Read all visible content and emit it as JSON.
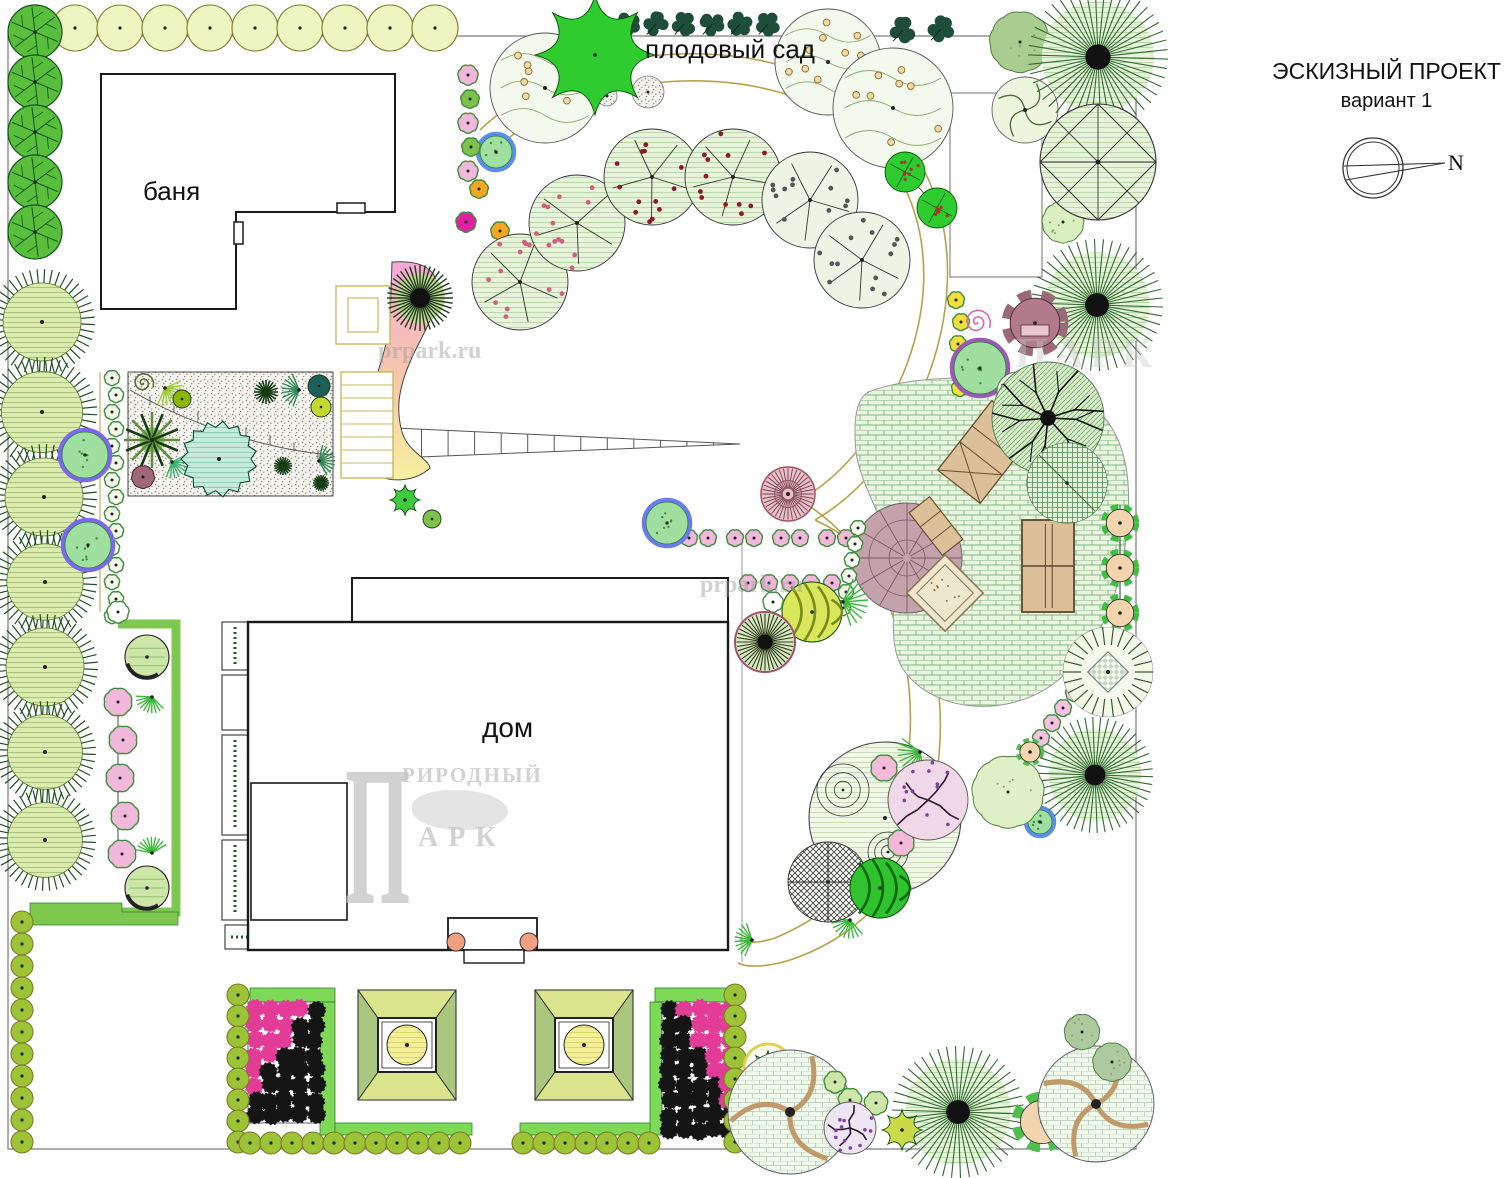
{
  "title": {
    "line1": "ЭСКИЗНЫЙ ПРОЕКТ",
    "line2": "вариант 1"
  },
  "compass": {
    "label": "N"
  },
  "labels": {
    "orchard": "плодовый сад",
    "bathhouse": "баня",
    "house": "дом"
  },
  "watermarks": {
    "site1": "prpark.ru",
    "site2": "prpark.ru",
    "logo_initial": "П",
    "logo_word1": "РИРОДНЫЙ",
    "logo_word2": "АРК",
    "logo_partial": "ПАРК"
  },
  "colors": {
    "boundary": "#777777",
    "path_tan": "#B5A24A",
    "building_line": "#1a1a1a",
    "green_band": "#7EC850",
    "hedge_olive": "#9CC436",
    "hedge_pale": "#EDF5C0",
    "pink_flower": "#F2B8DC",
    "black_flower": "#151515",
    "magenta_flower": "#E23C96",
    "furniture_tan": "#DCC09A",
    "plaza_mauve": "#C4A2AC",
    "gradient_pink": "#F9A8D8",
    "gradient_yellow": "#F7F0A0"
  },
  "plan": {
    "boundary": {
      "x": 8,
      "y": 36,
      "w": 1128,
      "h": 1113
    },
    "buildings": {
      "bathhouse_outline": [
        [
          101,
          74
        ],
        [
          395,
          74
        ],
        [
          395,
          212
        ],
        [
          236,
          212
        ],
        [
          236,
          309
        ],
        [
          101,
          309
        ]
      ],
      "bathhouse_door1": [
        337,
        203,
        28,
        10
      ],
      "bathhouse_door2": [
        234,
        222,
        9,
        22
      ],
      "house_porch": [
        352,
        578,
        376,
        44
      ],
      "house_main": [
        248,
        622,
        480,
        328
      ],
      "house_inner": [
        251,
        783,
        96,
        137
      ],
      "house_entry": [
        448,
        918,
        89,
        32
      ],
      "entry_step": [
        464,
        950,
        60,
        13
      ],
      "entry_posts": [
        [
          456,
          942,
          9
        ],
        [
          529,
          942,
          9
        ]
      ],
      "aux_plot": [
        950,
        93,
        92,
        184
      ]
    },
    "paths_tan": [
      "M480,130C585,30 800,25 900,135C965,210 960,330 905,425C880,468 850,500 815,520",
      "M492,152C590,60 790,55 880,150C940,220 935,325 885,410C862,450 835,480 800,500",
      "M815,520C900,560 945,640 940,740C935,850 880,930 790,960C765,968 745,967 738,963",
      "M800,500C875,545 915,635 910,735C905,835 855,905 775,938C757,944 744,943 740,939"
    ],
    "pergola": {
      "x1": 395,
      "yt": 428,
      "yb": 458,
      "x2": 740,
      "y2": 444,
      "ticks": 12
    },
    "gradient_bed": "M392,262 C420,260 438,268 437,290 C436,318 420,338 410,362 C398,390 396,410 402,432 C408,452 428,458 430,468 C415,482 388,484 372,472 C360,462 360,440 364,420 C370,390 388,350 390,320 Z",
    "rock_garden": [
      128,
      372,
      205,
      124
    ],
    "rock_curve": "M130,390 C210,436 290,452 333,455",
    "steps": {
      "deck": [
        336,
        286,
        54,
        58
      ],
      "deck_inner": [
        348,
        298,
        30,
        34
      ],
      "ladder": [
        341,
        372,
        52,
        106
      ]
    },
    "plaza": "M868,392 C920,372 1010,375 1065,392 C1115,408 1132,455 1128,515 C1124,585 1105,645 1052,685 C1005,718 935,712 905,672 C885,645 898,605 892,562 C886,520 860,485 856,452 C853,420 856,400 868,392 Z",
    "plaza_circle": [
      907,
      558,
      55
    ],
    "furniture": {
      "lounge": [
        986,
        452,
        38
      ],
      "bench": [
        936,
        526,
        -38
      ],
      "tennis": [
        1022,
        520,
        52,
        92
      ],
      "sandbox": [
        945,
        593,
        54
      ]
    },
    "planter_u": "M118,624 H176 V912 H118",
    "corner_band": "M30,925 L30,903 L122,903 L122,912 L178,912 L178,925 Z",
    "house_planters": [
      [
        222,
        622,
        26,
        48,
        1
      ],
      [
        222,
        675,
        26,
        55,
        0
      ],
      [
        222,
        735,
        26,
        100,
        1
      ],
      [
        222,
        840,
        26,
        80,
        1
      ],
      [
        225,
        925,
        220,
        24,
        2
      ]
    ],
    "parterres": {
      "left": {
        "interior": [
          248,
          1002,
          72,
          121
        ],
        "strips": [
          [
            250,
            988,
            85,
            14
          ],
          [
            320,
            1002,
            15,
            133
          ],
          [
            335,
            1123,
            137,
            12
          ]
        ],
        "pink_corner": "tl"
      },
      "right": {
        "interior": [
          662,
          1002,
          73,
          133
        ],
        "strips": [
          [
            655,
            988,
            80,
            14
          ],
          [
            650,
            1002,
            12,
            133
          ],
          [
            520,
            1123,
            130,
            12
          ]
        ],
        "pink_corner": "tr"
      }
    },
    "pavilions": [
      [
        358,
        990
      ],
      [
        535,
        990
      ]
    ],
    "compass": {
      "cx": 1373,
      "cy": 168,
      "r": 30
    },
    "rows": [
      {
        "sym": "hedge",
        "x": 75,
        "y": 28,
        "dx": 45,
        "dy": 0,
        "n": 9,
        "r": 23,
        "c": "#EDF5C0",
        "s": "#7A7A28",
        "line": 1
      },
      {
        "sym": "splat",
        "x": 628,
        "y": 24,
        "dx": 28,
        "dy": 0,
        "n": 6,
        "r": 13,
        "c": "#1E4D3A"
      },
      {
        "sym": "vein",
        "x": 35,
        "y": 32,
        "dx": 0,
        "dy": 50,
        "n": 5,
        "r": 27,
        "c": "#58BE3C"
      },
      {
        "sym": "hedge",
        "x": 22,
        "y": 922,
        "dx": 0,
        "dy": 22,
        "n": 11,
        "r": 11,
        "c": "#9CC436",
        "s": "#2F4F1F",
        "line": 1
      },
      {
        "sym": "hedge",
        "x": 238,
        "y": 995,
        "dx": 0,
        "dy": 21,
        "n": 8,
        "r": 11,
        "c": "#9CC436",
        "s": "#2F4F1F",
        "line": 1
      },
      {
        "sym": "hedge",
        "x": 250,
        "y": 1143,
        "dx": 21,
        "dy": 0,
        "n": 11,
        "r": 11,
        "c": "#9CC436",
        "s": "#2F4F1F",
        "line": 1
      },
      {
        "sym": "hedge",
        "x": 523,
        "y": 1143,
        "dx": 21,
        "dy": 0,
        "n": 7,
        "r": 11,
        "c": "#9CC436",
        "s": "#2F4F1F",
        "line": 1
      },
      {
        "sym": "hedge",
        "x": 735,
        "y": 995,
        "dx": 0,
        "dy": 21,
        "n": 8,
        "r": 11,
        "c": "#9CC436",
        "s": "#2F4F1F",
        "line": 1
      },
      {
        "sym": "scallop",
        "x": 112,
        "y": 378,
        "dx": 0,
        "dy": 17,
        "n": 15,
        "r": 9,
        "c": "#F2F7EA",
        "z": 1
      },
      {
        "sym": "scallop",
        "x": 118,
        "y": 702,
        "dx": 1,
        "dy": 38,
        "n": 5,
        "r": 17,
        "c": "#F2B8DC",
        "z": 1
      },
      {
        "sym": "scallop",
        "x": 662,
        "y": 538,
        "dx": 23,
        "dy": 0,
        "n": 9,
        "r": 10,
        "c": "#F2B8DC",
        "z": 1
      },
      {
        "sym": "scallop",
        "x": 748,
        "y": 583,
        "dx": 21,
        "dy": 0,
        "n": 5,
        "r": 10,
        "c": "#F2B8DC"
      },
      {
        "sym": "scallop",
        "x": 956,
        "y": 300,
        "dx": 1,
        "dy": 22,
        "n": 5,
        "r": 10,
        "c": "#F2DE3C",
        "z": 1
      },
      {
        "sym": "scallop",
        "x": 1107,
        "y": 648,
        "dx": -11,
        "dy": 15,
        "n": 7,
        "r": 10,
        "c": "#F4C2E0"
      },
      {
        "sym": "scallop",
        "x": 858,
        "y": 528,
        "dx": -3,
        "dy": 16,
        "n": 6,
        "r": 9,
        "c": "#F8F8F0"
      },
      {
        "sym": "gear",
        "x": 1120,
        "y": 523,
        "dx": 0,
        "dy": 45,
        "n": 3,
        "r": 19,
        "c": "#3FBF3F",
        "line": 1
      }
    ],
    "plants": [
      [
        "spiky",
        42,
        322,
        50
      ],
      [
        "spiky",
        42,
        412,
        52
      ],
      [
        "spiky",
        44,
        497,
        50
      ],
      [
        "spiky",
        45,
        582,
        49
      ],
      [
        "spiky",
        45,
        667,
        50
      ],
      [
        "spiky",
        45,
        752,
        48
      ],
      [
        "spiky",
        45,
        840,
        48
      ],
      [
        "ring",
        85,
        455,
        23,
        "#7B68EE"
      ],
      [
        "ring",
        88,
        545,
        23,
        "#7B68EE"
      ],
      [
        "ring",
        667,
        523,
        21,
        "#6B7BEE"
      ],
      [
        "ring",
        980,
        368,
        26,
        "#9B59B6"
      ],
      [
        "ring",
        496,
        152,
        16,
        "#5B8DEF"
      ],
      [
        "ring",
        1040,
        822,
        12,
        "#5B8DEF"
      ],
      [
        "shaded",
        147,
        657,
        22
      ],
      [
        "shaded",
        147,
        888,
        22
      ],
      [
        "fan",
        152,
        697,
        13,
        "#3CB83C"
      ],
      [
        "fan",
        152,
        853,
        13,
        "#3CB83C"
      ],
      [
        "scallop",
        118,
        612,
        13,
        "#FFFFFF"
      ],
      [
        "spiral",
        143,
        383,
        11,
        "#556B2F"
      ],
      [
        "fan",
        165,
        388,
        14,
        "#9ACD32"
      ],
      [
        "disc",
        182,
        399,
        9,
        "#8DB600"
      ],
      [
        "conif",
        266,
        392,
        12
      ],
      [
        "fan",
        299,
        390,
        14,
        "#2E8B57"
      ],
      [
        "disc",
        319,
        386,
        11,
        "#1F5F5B"
      ],
      [
        "disc",
        321,
        407,
        10,
        "#C3D930"
      ],
      [
        "palm",
        152,
        440,
        28
      ],
      [
        "fan",
        172,
        462,
        13,
        "#3CB371"
      ],
      [
        "mauve",
        143,
        477,
        14
      ],
      [
        "zig",
        219,
        459,
        38
      ],
      [
        "conif",
        283,
        466,
        9
      ],
      [
        "fan",
        319,
        461,
        13,
        "#2E8B57"
      ],
      [
        "conif",
        321,
        483,
        8
      ],
      [
        "radialD",
        420,
        298,
        33
      ],
      [
        "star",
        405,
        500,
        15,
        "#3ECC3E"
      ],
      [
        "disc",
        432,
        519,
        9,
        "#7CC24C"
      ],
      [
        "scallop",
        468,
        75,
        12,
        "#F2B8DC"
      ],
      [
        "scallop",
        470,
        99,
        11,
        "#7CC24C"
      ],
      [
        "scallop",
        468,
        123,
        12,
        "#F2B8DC"
      ],
      [
        "scallop",
        471,
        147,
        11,
        "#7CC24C"
      ],
      [
        "scallop",
        468,
        171,
        12,
        "#F2B8DC"
      ],
      [
        "scallop",
        479,
        189,
        11,
        "#F5A623"
      ],
      [
        "scallop",
        500,
        231,
        11,
        "#F5A623"
      ],
      [
        "scallop",
        466,
        222,
        12,
        "#E020A0"
      ],
      [
        "dot",
        545,
        88,
        55
      ],
      [
        "dot",
        828,
        62,
        53
      ],
      [
        "dot",
        893,
        108,
        60
      ],
      [
        "stip",
        648,
        92,
        16
      ],
      [
        "stip",
        607,
        96,
        10
      ],
      [
        "star",
        595,
        55,
        60,
        "#2ECC2E"
      ],
      [
        "cloud",
        1020,
        42,
        38,
        "#A9CD90"
      ],
      [
        "swirl",
        1025,
        110,
        33
      ],
      [
        "flecks",
        905,
        172,
        20
      ],
      [
        "flecks",
        937,
        208,
        20
      ],
      [
        "splat",
        903,
        30,
        14,
        "#1E4D3A"
      ],
      [
        "splat",
        941,
        29,
        14,
        "#1E4D3A"
      ],
      [
        "cloud",
        1063,
        222,
        26,
        "#D9EFC0"
      ],
      [
        "radial",
        1098,
        57,
        70
      ],
      [
        "radial",
        1097,
        305,
        66
      ],
      [
        "radial",
        1095,
        775,
        58
      ],
      [
        "radial",
        958,
        1112,
        66
      ],
      [
        "geo",
        1098,
        162,
        58
      ],
      [
        "fruit",
        520,
        282,
        48,
        "pink"
      ],
      [
        "fruit",
        577,
        223,
        48,
        "pink"
      ],
      [
        "fruit",
        652,
        177,
        48,
        "red"
      ],
      [
        "fruit",
        733,
        177,
        48,
        "red"
      ],
      [
        "fruit",
        810,
        200,
        48,
        "grav"
      ],
      [
        "fruit",
        862,
        260,
        48,
        "grav"
      ],
      [
        "spiralp",
        977,
        322,
        14,
        "#E060B0"
      ],
      [
        "gearm",
        1035,
        323,
        33
      ],
      [
        "swirl",
        1017,
        392,
        20
      ],
      [
        "branchrad",
        1048,
        418,
        56
      ],
      [
        "plaid",
        1067,
        483,
        40
      ],
      [
        "spikering",
        1108,
        672,
        45
      ],
      [
        "conc",
        885,
        818,
        76
      ],
      [
        "scallop",
        884,
        768,
        16,
        "#F4B8D8"
      ],
      [
        "scallop",
        901,
        843,
        16,
        "#F4B8D8"
      ],
      [
        "fan",
        920,
        752,
        18,
        "#3CB83C"
      ],
      [
        "fan",
        850,
        920,
        15,
        "#3CB83C"
      ],
      [
        "branchp",
        928,
        800,
        40,
        "#EFD8E8"
      ],
      [
        "xh",
        828,
        882,
        40
      ],
      [
        "ball",
        880,
        888,
        30,
        "#2FC42F"
      ],
      [
        "cloud",
        1008,
        792,
        45,
        "#DFF0C8"
      ],
      [
        "ringstar",
        768,
        1068,
        24
      ],
      [
        "brick",
        790,
        1112,
        62,
        "arm"
      ],
      [
        "scallop",
        835,
        1082,
        13,
        "#CFE6A8"
      ],
      [
        "scallop",
        850,
        1100,
        14,
        "#CFE6A8"
      ],
      [
        "scallop",
        876,
        1103,
        14,
        "#CFE6A8"
      ],
      [
        "branchp",
        850,
        1128,
        26,
        "#EDE6F2"
      ],
      [
        "star",
        902,
        1130,
        20,
        "#CADB4A"
      ],
      [
        "gear",
        1042,
        1122,
        30,
        "#4CBF4C"
      ],
      [
        "brick",
        1096,
        1104,
        58,
        "swirl"
      ],
      [
        "cloud",
        1082,
        1032,
        22,
        "#AEC9A0"
      ],
      [
        "cloud",
        1112,
        1062,
        24,
        "#AEC9A0"
      ],
      [
        "ball",
        812,
        612,
        30,
        "#D9E85A"
      ],
      [
        "fan",
        843,
        602,
        20,
        "#3CB83C"
      ],
      [
        "scallop",
        773,
        602,
        12,
        "#FFFFFF"
      ],
      [
        "rdisc",
        765,
        642,
        30,
        "dark"
      ],
      [
        "rdisc",
        788,
        494,
        27,
        "pink"
      ],
      [
        "fan",
        752,
        940,
        14,
        "#3CB83C"
      ],
      [
        "gear",
        1030,
        752,
        14,
        "#4CBF4C"
      ]
    ],
    "connectors": [
      [
        520,
        282,
        577,
        223
      ],
      [
        652,
        177,
        733,
        177
      ],
      [
        810,
        200,
        862,
        260
      ],
      [
        905,
        172,
        937,
        208
      ],
      [
        55,
        28,
        458,
        28
      ],
      [
        118,
        690,
        118,
        858
      ],
      [
        1120,
        505,
        1120,
        630
      ]
    ],
    "guides": [
      [
        100,
        372,
        100,
        612,
        "#B5A24A"
      ],
      [
        742,
        540,
        742,
        962,
        "#999999"
      ]
    ]
  }
}
